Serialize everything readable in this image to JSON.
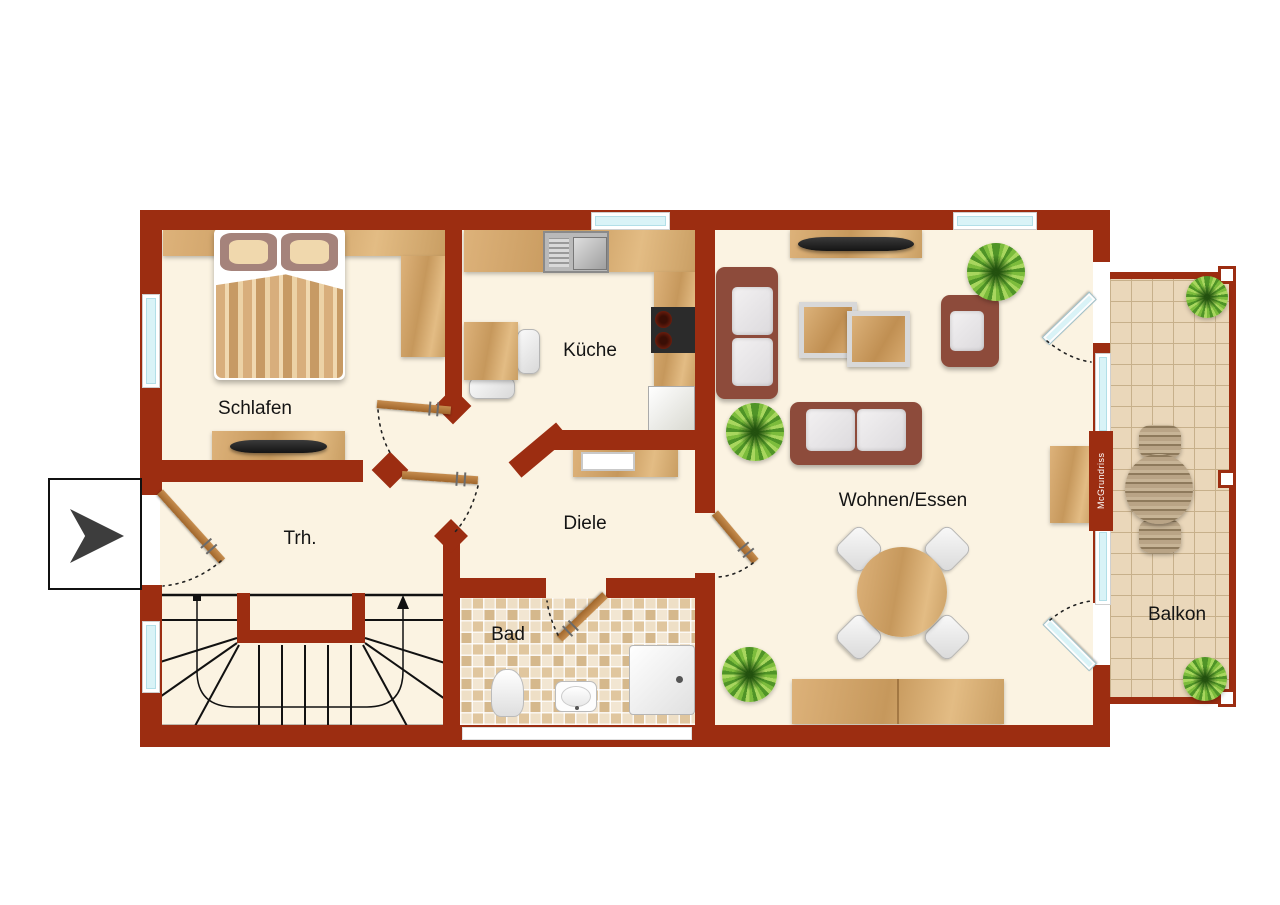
{
  "document": {
    "type": "floor-plan",
    "language": "de"
  },
  "colors": {
    "wall": "#9c2d11",
    "floor": "#fbf3e2",
    "outside": "#ffffff",
    "window_glass": "#d9f3f7",
    "wood": "#cfa063",
    "upholstery": "#8d4b3b",
    "cushion": "#e9e7e8",
    "plant_green": "#7cbc3c",
    "balcony_tile": "#ead7ba",
    "stair_line": "#111111"
  },
  "rooms": [
    {
      "id": "schlafen",
      "label": "Schlafen",
      "furniture": [
        "double-bed",
        "wardrobe",
        "tv-sideboard"
      ]
    },
    {
      "id": "kueche",
      "label": "Küche",
      "furniture": [
        "sink-counter",
        "cooktop-counter",
        "tall-cabinet",
        "table",
        "chairs"
      ]
    },
    {
      "id": "diele",
      "label": "Diele",
      "furniture": [
        "desk"
      ]
    },
    {
      "id": "trh",
      "label": "Trh.",
      "furniture": [
        "winder-staircase"
      ]
    },
    {
      "id": "bad",
      "label": "Bad",
      "furniture": [
        "toilet",
        "washbasin",
        "shower"
      ]
    },
    {
      "id": "wohnen",
      "label": "Wohnen/Essen",
      "furniture": [
        "tv-sideboard",
        "sofa",
        "loveseat",
        "armchair",
        "coffee-tables",
        "round-dining-table",
        "sideboard",
        "desk",
        "plants"
      ]
    },
    {
      "id": "balkon",
      "label": "Balkon",
      "furniture": [
        "bistro-table",
        "chairs",
        "plants"
      ]
    }
  ],
  "watermark": {
    "label": "McGrundriss"
  },
  "entrance": {
    "marker": "right-arrow"
  }
}
